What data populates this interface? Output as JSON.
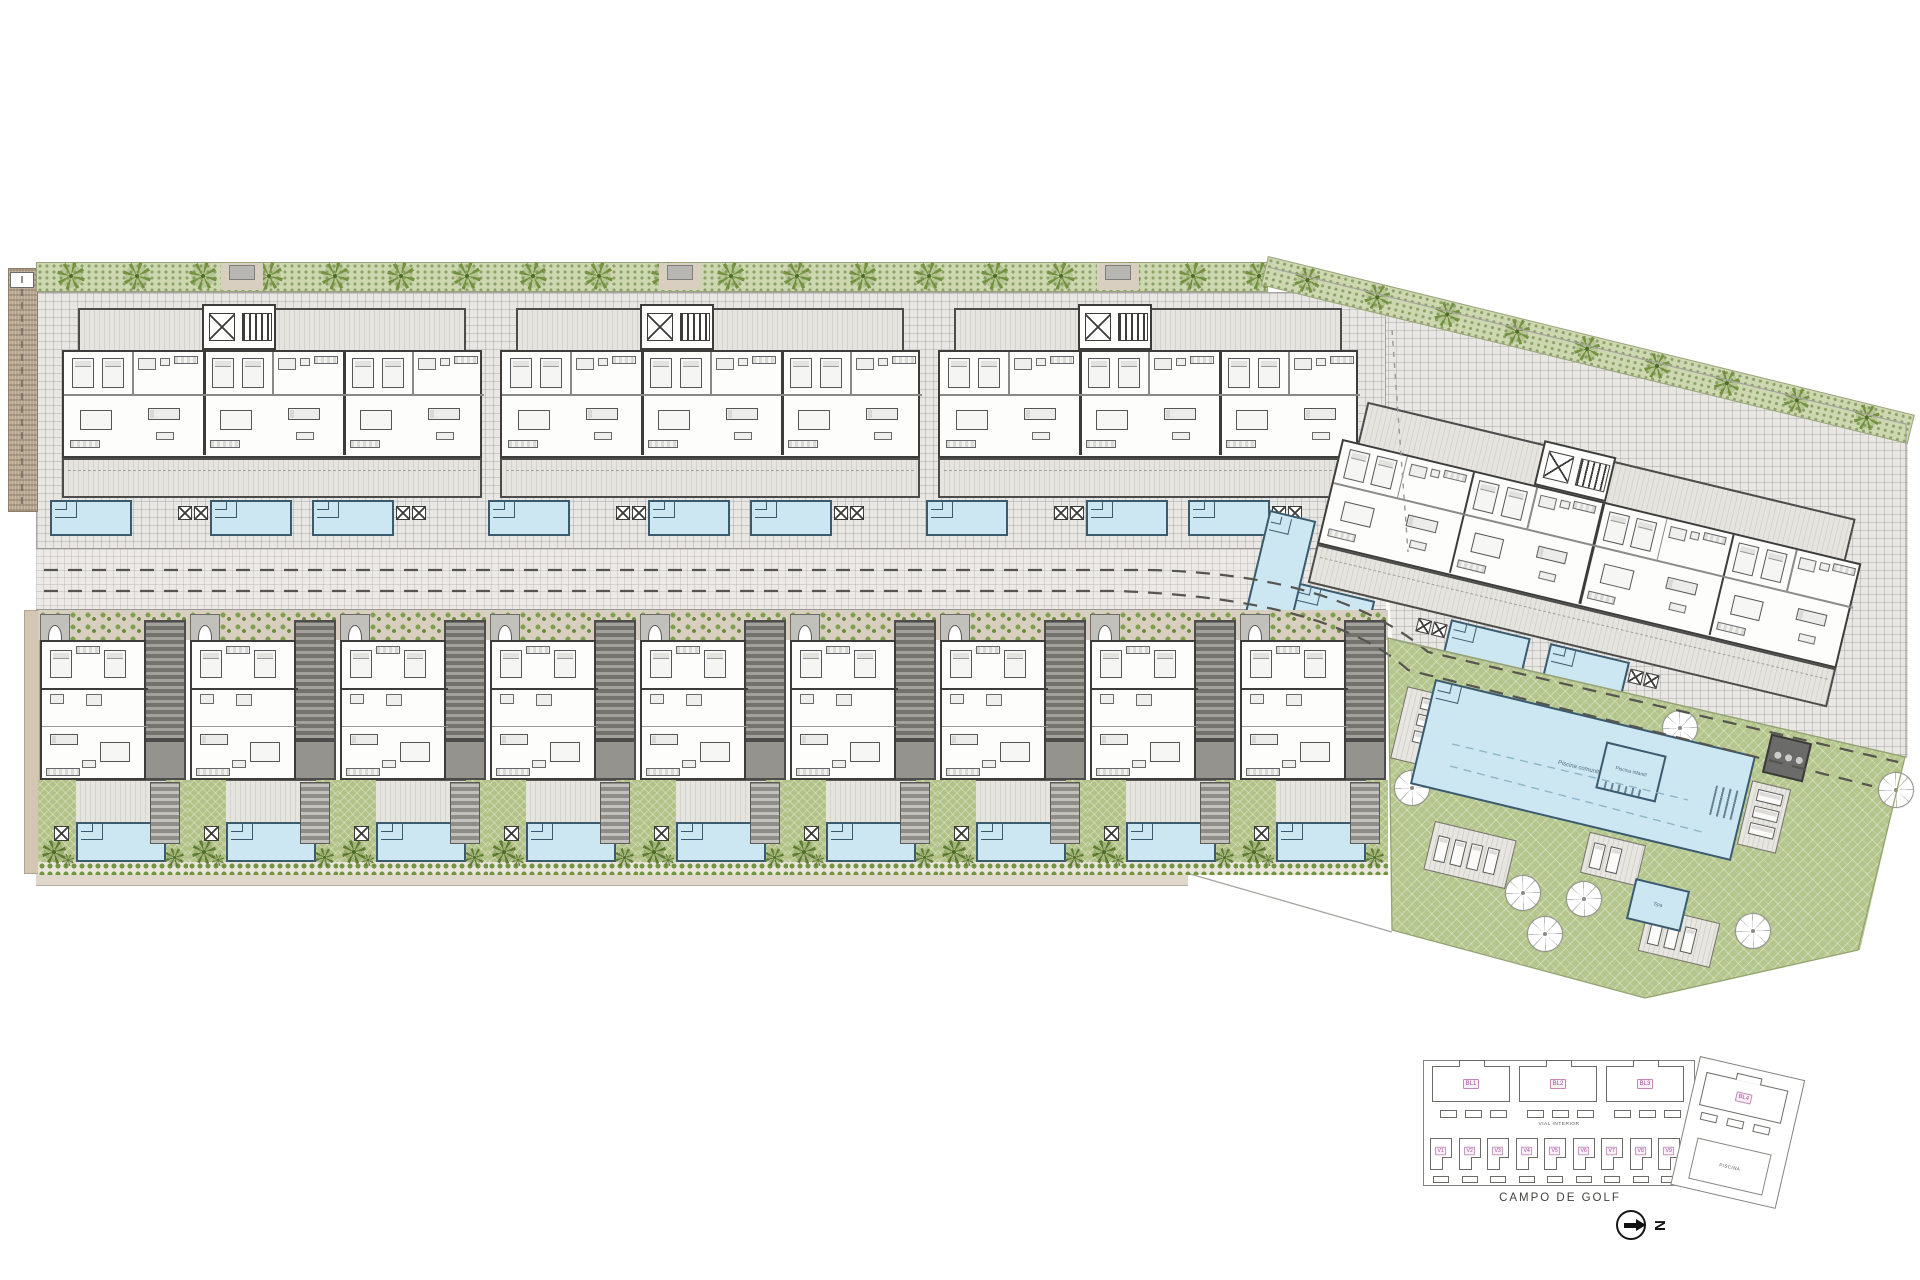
{
  "colors": {
    "paving": "#e9e7e3",
    "wall": "#3c3c3a",
    "pool_fill": "#cde7f2",
    "pool_edge": "#3a5a6e",
    "green": "#b5c68c",
    "garden": "#b2c287",
    "hedge": "#cdd7b0",
    "tree": "#74923f",
    "earth": "#b7a78f",
    "pink": "#a4499a"
  },
  "main_plan": {
    "buildings": [
      "BL1",
      "BL2",
      "BL3"
    ],
    "building_right": "BL4",
    "villas": [
      "V1",
      "V2",
      "V3",
      "V4",
      "V5",
      "V6",
      "V7",
      "V8",
      "V9"
    ],
    "communal": {
      "main_pool_label": "Piscina comunitaria",
      "kids_pool_label": "Piscina infantil",
      "spa_label": "Spa"
    }
  },
  "key_plan": {
    "blocks": [
      "BL1",
      "BL2",
      "BL3"
    ],
    "block_right": "BL4",
    "villas": [
      "V1",
      "V2",
      "V3",
      "V4",
      "V5",
      "V6",
      "V7",
      "V8",
      "V9"
    ],
    "road_label": "VIAL INTERIOR",
    "pool_label": "PISCINA",
    "golf_label": "CAMPO DE GOLF",
    "north_label": "N"
  }
}
